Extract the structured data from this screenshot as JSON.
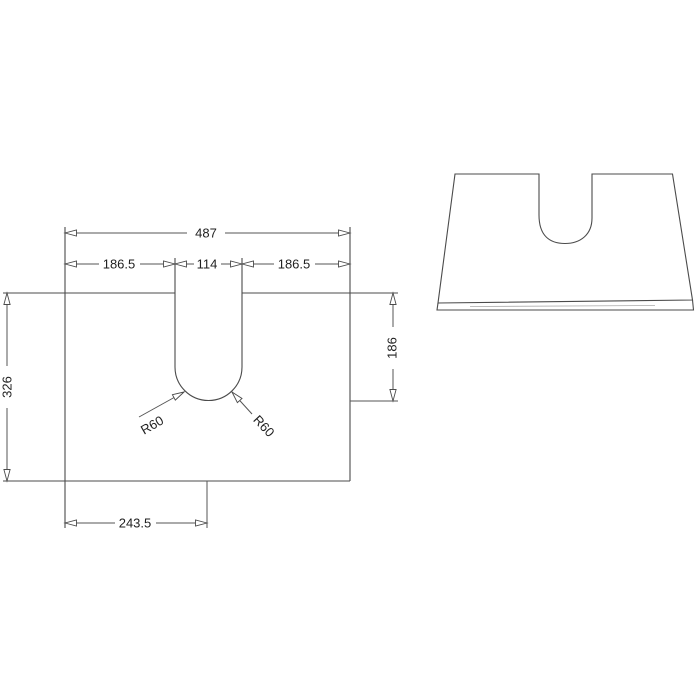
{
  "document": {
    "kind": "technical-dimension-drawing",
    "background_color": "#ffffff",
    "line_color": "#4b4b4b",
    "text_color": "#1f1f1f"
  },
  "plan_view": {
    "overall_width": "487",
    "left_to_cutout": "186.5",
    "cutout_width": "114",
    "cutout_to_right": "186.5",
    "overall_depth": "326",
    "cutout_depth": "186",
    "left_to_cutout_far_edge": "243.5",
    "radius_left": "R60",
    "radius_right": "R60"
  }
}
